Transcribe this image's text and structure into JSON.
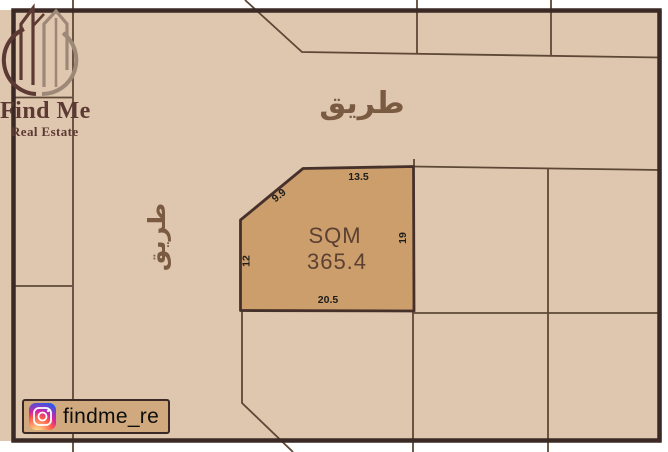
{
  "branding": {
    "logo_title": "Find Me",
    "logo_subtitle": "Real Estate",
    "instagram_handle": "findme_re",
    "colors": {
      "logo_dark": "#5c3a33",
      "logo_taupe": "#9d8878"
    }
  },
  "map": {
    "road_label_top": "طريق",
    "road_label_left": "طريق",
    "colors": {
      "background": "#dfc6ae",
      "boundary_line": "#5d4736",
      "outer_border": "#3a2924",
      "road_text": "#7a5a40",
      "plot_fill": "#cb9e6c",
      "plot_text": "#5c4032",
      "dimension_text": "#1f1d1b"
    },
    "highlighted_plot": {
      "area_label": "SQM",
      "area_value": "365.4",
      "dimensions": {
        "top": "13.5",
        "diagonal": "9.9",
        "right": "19",
        "left": "12",
        "bottom": "20.5"
      }
    }
  }
}
